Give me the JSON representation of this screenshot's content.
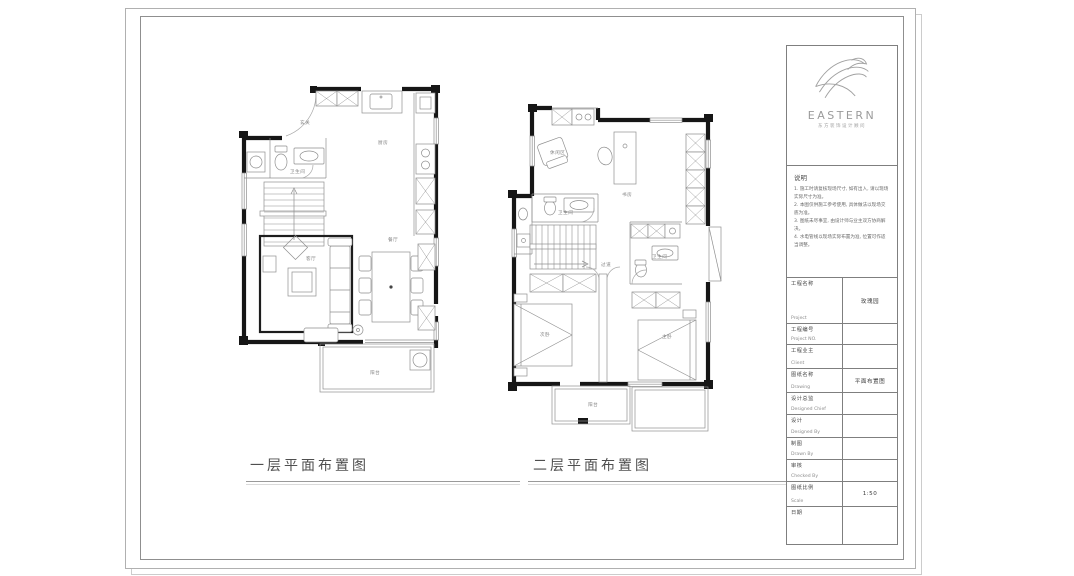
{
  "sheet": {
    "kind": "interior design drawing sheet"
  },
  "plans": [
    {
      "title": "一层平面布置图",
      "rooms": [
        {
          "label": "玄关",
          "x": 70,
          "y": 46
        },
        {
          "label": "卫生间",
          "x": 60,
          "y": 95
        },
        {
          "label": "厨房",
          "x": 148,
          "y": 66
        },
        {
          "label": "客厅",
          "x": 76,
          "y": 182
        },
        {
          "label": "餐厅",
          "x": 158,
          "y": 163
        },
        {
          "label": "阳台",
          "x": 140,
          "y": 296
        }
      ]
    },
    {
      "title": "二层平面布置图",
      "rooms": [
        {
          "label": "休闲区",
          "x": 48,
          "y": 58
        },
        {
          "label": "书房",
          "x": 120,
          "y": 100
        },
        {
          "label": "卫生间",
          "x": 56,
          "y": 118
        },
        {
          "label": "卫生间",
          "x": 150,
          "y": 162
        },
        {
          "label": "过道",
          "x": 99,
          "y": 170
        },
        {
          "label": "次卧",
          "x": 38,
          "y": 240
        },
        {
          "label": "主卧",
          "x": 160,
          "y": 242
        },
        {
          "label": "阳台",
          "x": 86,
          "y": 310
        }
      ]
    }
  ],
  "title_block": {
    "logo": {
      "text": "EASTERN",
      "subtext": "东方装饰设计顾问"
    },
    "notes": {
      "heading": "说明",
      "items": [
        "1. 施工时请复核现场尺寸, 如有出入, 请以现场实际尺寸为准。",
        "2. 本图仅供施工参考使用, 具体做法以现场交底为准。",
        "3. 图纸未尽事宜, 由设计师与业主双方协商解决。",
        "4. 水电管线以现场实际布置为准, 位置可作适当调整。"
      ]
    },
    "fields": [
      {
        "zh": "工程名称",
        "en": "Project",
        "value": "玫瑰园"
      },
      {
        "zh": "工程编号",
        "en": "Project NO.",
        "value": ""
      },
      {
        "zh": "工程业主",
        "en": "Client",
        "value": ""
      },
      {
        "zh": "图纸名称",
        "en": "Drawing",
        "value": "平面布置图"
      },
      {
        "zh": "设计总监",
        "en": "Designed Chief",
        "value": ""
      },
      {
        "zh": "设计",
        "en": "Designed By",
        "value": ""
      },
      {
        "zh": "制图",
        "en": "Drawn By",
        "value": ""
      },
      {
        "zh": "审核",
        "en": "Checked By",
        "value": ""
      },
      {
        "zh": "图纸比例",
        "en": "Scale",
        "value": "1:50"
      },
      {
        "zh": "日期",
        "en": "",
        "value": ""
      }
    ]
  },
  "colors": {
    "wall": "#161616",
    "thin_line": "#8f8f8f",
    "frame": "#8f8f8f",
    "label": "#858585",
    "title_text": "#4f4f4f"
  }
}
